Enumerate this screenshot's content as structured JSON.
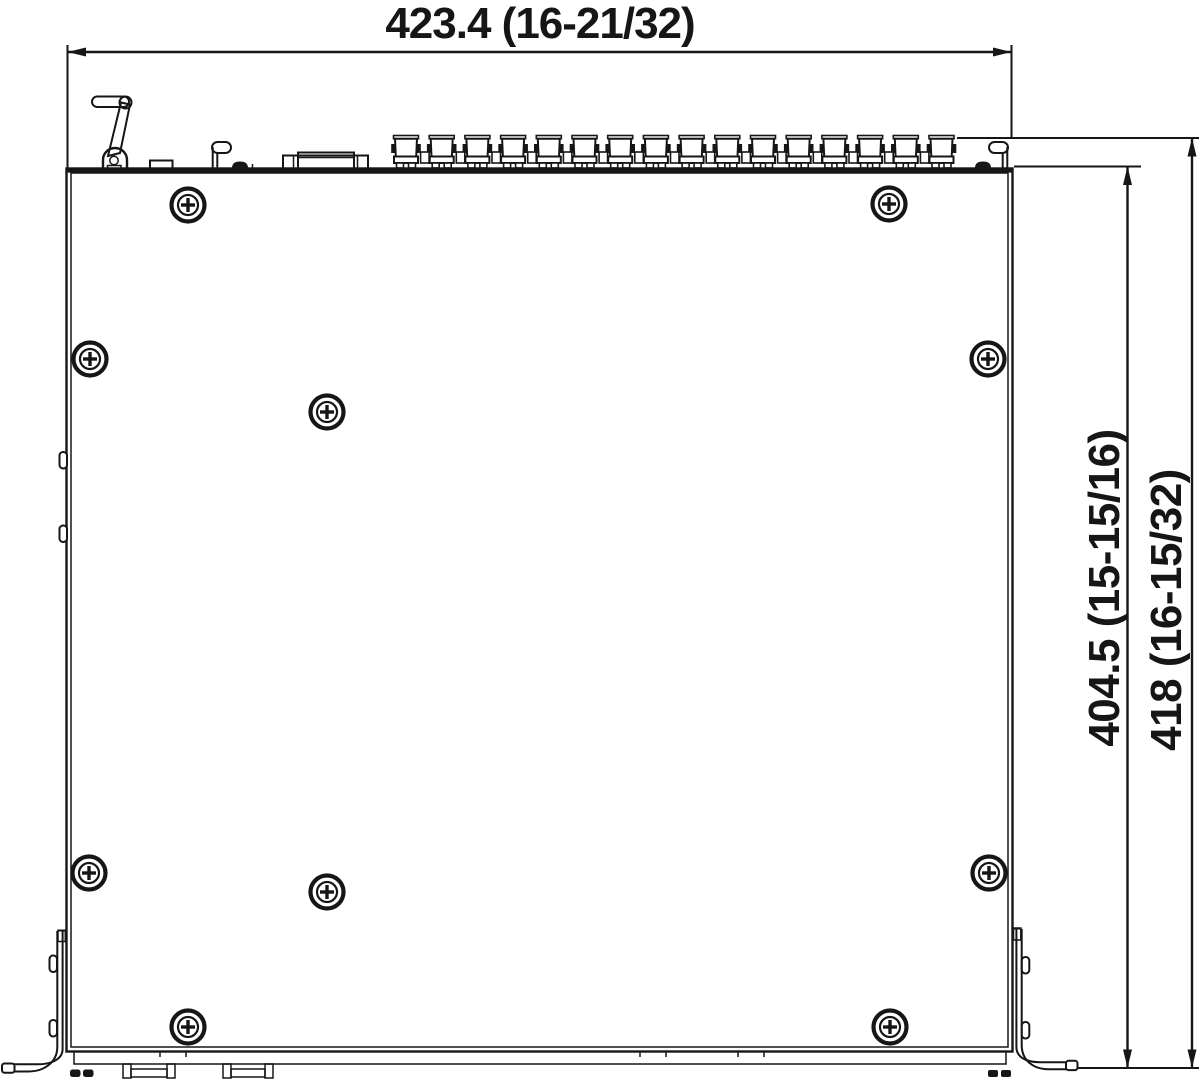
{
  "drawing": {
    "type": "mechanical-dimension-top-view",
    "unit_style": "millimeters (inches)",
    "dimensions": {
      "width_label": "423.4 (16-21/32)",
      "depth_body_label": "404.5 (15-15/16)",
      "depth_overall_label": "418 (16-15/32)"
    },
    "colors": {
      "line": "#161616",
      "background": "#ffffff"
    },
    "counts": {
      "rear_connectors": 16,
      "chassis_screws": 10
    }
  }
}
